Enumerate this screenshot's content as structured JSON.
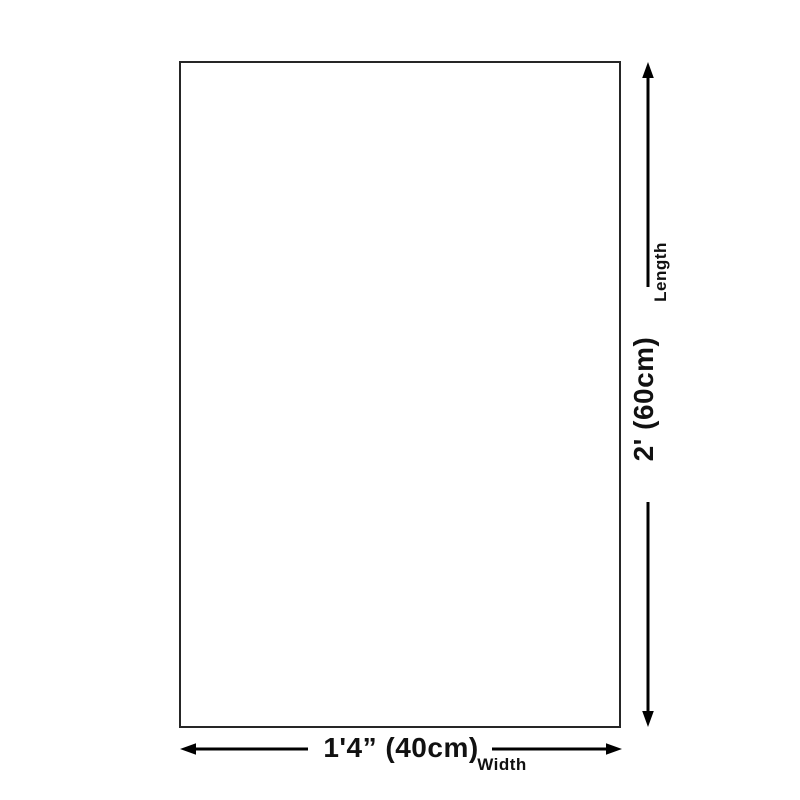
{
  "theme": {
    "page_bg": "#ffffff",
    "rect_fill": "#ffffff",
    "rect_border": "#262626",
    "arrow_color": "#000000",
    "text_color": "#111111"
  },
  "diagram": {
    "shape": "empty-rectangle-dimension-diagram",
    "vertical_dimension": {
      "axis_label": "Length",
      "value": "2' (60cm)"
    },
    "horizontal_dimension": {
      "axis_label": "Width",
      "value": "1'4” (40cm)"
    }
  }
}
